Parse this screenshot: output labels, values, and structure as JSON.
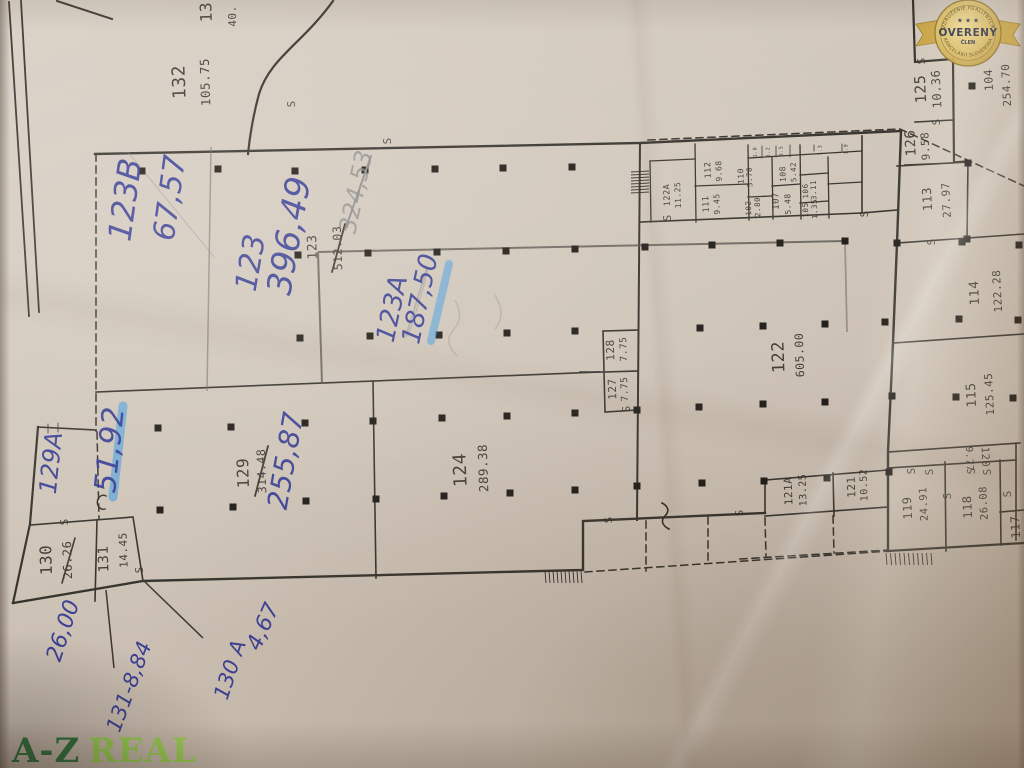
{
  "colors": {
    "ink": "#2f3590",
    "hl": "#3f9be0",
    "logo-dark": "#1d6e33",
    "logo-light": "#98d64b",
    "badge-gold": "#c9a23c",
    "badge-text": "#20243f",
    "paper": "#cdc2b6"
  },
  "marker": {
    "s": "S"
  },
  "logo": {
    "part1": "A-Z",
    "part2": "REAL"
  },
  "badge": {
    "arc_top": "ZDRUŽENIE REALITNÝCH",
    "stars": "★ ★ ★",
    "title": "OVERENÝ",
    "member": "ČLEN",
    "arc_bottom": "KANCELÁRIÍ SLOVENSKA"
  },
  "rooms": {
    "r132": {
      "no": "132",
      "area": "105.75"
    },
    "r13x": {
      "no": "13",
      "area": "40."
    },
    "r123p": {
      "no": "123",
      "area": "512.03"
    },
    "r124": {
      "no": "124",
      "area": "289.38"
    },
    "r129": {
      "no": "129",
      "area": "314.48"
    },
    "r122": {
      "no": "122",
      "area": "605.00"
    },
    "r127": {
      "no": "127",
      "area": "7.75"
    },
    "r128": {
      "no": "128",
      "area": "7.75"
    },
    "r130": {
      "no": "130",
      "area": "26.26"
    },
    "r131": {
      "no": "131",
      "area": "14.45"
    },
    "r122a": {
      "no": "122A",
      "area": "11.25"
    },
    "r112": {
      "no": "112",
      "area": "9.68"
    },
    "r111": {
      "no": "111",
      "area": "9.45"
    },
    "r110": {
      "no": "110",
      "area": "5.70"
    },
    "r102": {
      "no": "102",
      "area": "2.80"
    },
    "r107": {
      "no": "107",
      "area": "5.48"
    },
    "r108": {
      "no": "108",
      "area": "5.42"
    },
    "r106": {
      "no": "106",
      "area": "3.11"
    },
    "r105": {
      "no": "105",
      "area": "1.35"
    },
    "r125": {
      "no": "125",
      "area": "10.36"
    },
    "r126": {
      "no": "126",
      "area": "9.58"
    },
    "r104": {
      "no": "104",
      "area": "254.70"
    },
    "r113": {
      "no": "113",
      "area": "27.97"
    },
    "r114": {
      "no": "114",
      "area": "122.28"
    },
    "r115": {
      "no": "115",
      "area": "125.45"
    },
    "r121a": {
      "no": "121A",
      "area": "13.25"
    },
    "r121": {
      "no": "121",
      "area": "10.52"
    },
    "r119": {
      "no": "119",
      "area": "24.91"
    },
    "r118": {
      "no": "118",
      "area": "26.08"
    },
    "r120": {
      "no": "120",
      "area": "9.77"
    },
    "r117": {
      "no": "117"
    }
  },
  "micro": [
    "1.8",
    "1.2",
    "1.5",
    "1.3",
    "1.9"
  ],
  "notes": {
    "n123b": {
      "no": "123B",
      "area": "67,57"
    },
    "n123": {
      "no": "123",
      "area": "396,49"
    },
    "n123a": {
      "no": "123A",
      "area": "187,50"
    },
    "n129a": {
      "no": "129A",
      "area": "51,92"
    },
    "n255": "255,87",
    "p324": "324,53",
    "n2600": "26,00",
    "n131": "131-8,84",
    "n130a": {
      "no": "130 A",
      "area": "4,67"
    }
  }
}
